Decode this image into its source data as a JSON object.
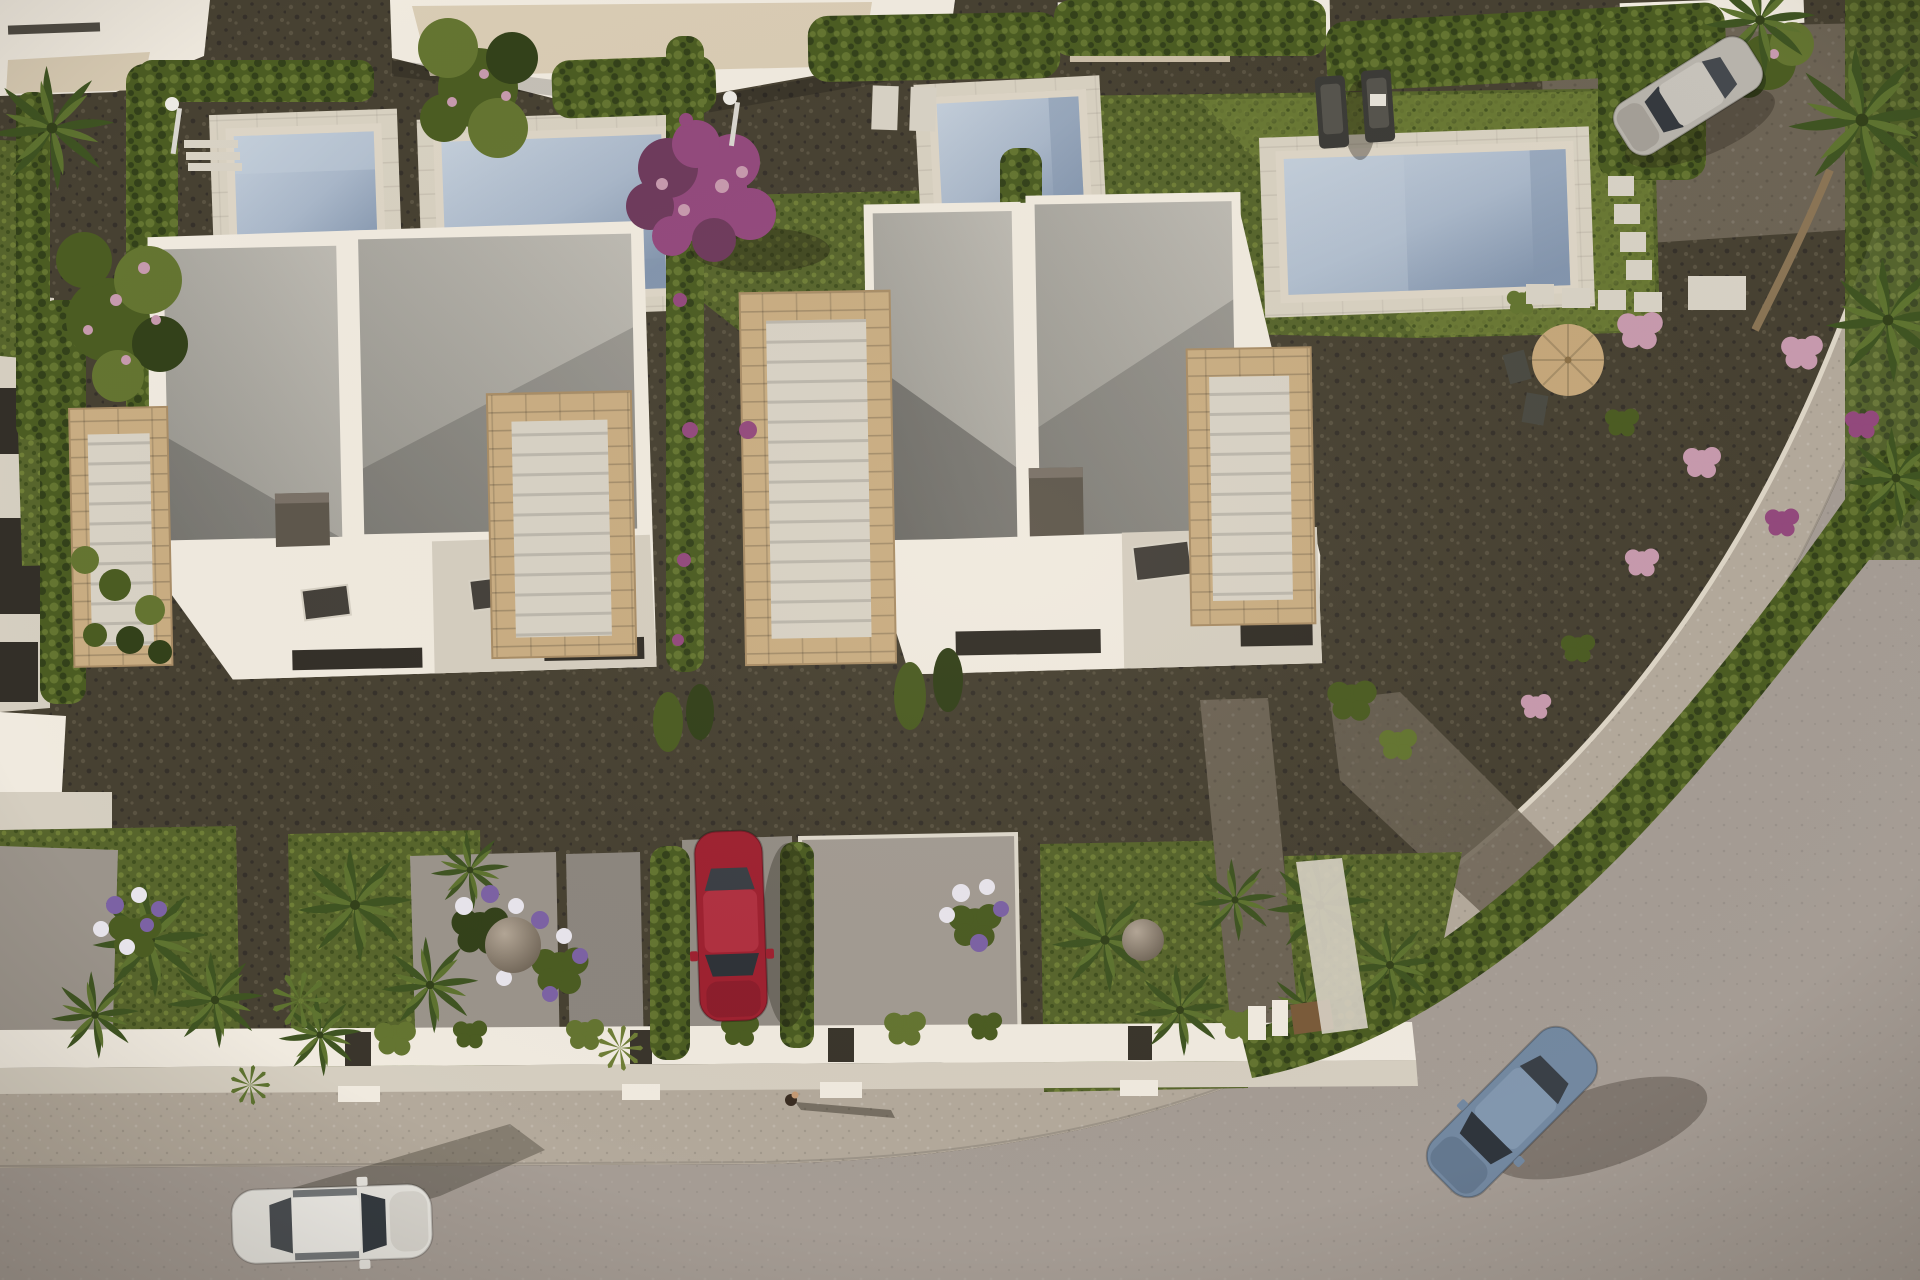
{
  "meta": {
    "title": "Aerial 3D architectural rendering of modern white villas with private pools",
    "view": "top-down bird's-eye view, late-afternoon warm sunlight, long shadows cast to the east",
    "width_px": 1920,
    "height_px": 1280
  },
  "palette": {
    "gravel": "#474132",
    "gravel_light": "#5a5342",
    "gravel_dark": "#36312a",
    "drive_gravel": "#6d6455",
    "tan_path": "#8f7f66",
    "grass": "#57652c",
    "grass_light": "#6f7e37",
    "grass_dark": "#41501f",
    "hedge": "#4b5c22",
    "hedge_light": "#647531",
    "hedge_dark": "#33411a",
    "road": "#a59c94",
    "sidewalk": "#b3a99b",
    "curb": "#ddd5c6",
    "wall": "#f0eadf",
    "wall_shade": "#d5cec0",
    "deck": "#d8d1c1",
    "terrace": "#d9ccb4",
    "roof_light": "#bebbb3",
    "roof_mid": "#94928b",
    "roof_deep": "#63655f",
    "stone": "#c9ad82",
    "stone_dark": "#a98d66",
    "steps": "#d8d2c5",
    "chimney": "#5e574c",
    "chimney_top": "#7a7167",
    "window_dark": "#332f28",
    "water": "#a9b7c9",
    "water_light": "#c3ceda",
    "water_dark": "#8395ad",
    "car_white": "#e8e6e0",
    "car_white_roof": "#f1efeа",
    "car_red": "#9e2130",
    "car_red_roof": "#b03040",
    "car_blue": "#7388a0",
    "car_blue_roof": "#8297ae",
    "car_silver": "#b7b3ab",
    "glass": "#343a40",
    "flower_magenta": "#93497d",
    "flower_magenta_dark": "#6e3a5c",
    "flower_purple": "#7c62a4",
    "flower_pink": "#c79aae",
    "flower_white": "#e8e5ec",
    "palm": "#5e7330",
    "palm_dark": "#3f5422",
    "trunk": "#8a7455",
    "parasol": "#c5a77a",
    "lounger": "#3c3b37",
    "lounger_pad": "#56544d",
    "sphere_light": "#b3a696",
    "sphere_dark": "#6e6355",
    "gate_wood": "#7a5b3a",
    "skin": "#c49a74",
    "shadow": "rgba(28,22,13,0.35)"
  },
  "scene": {
    "buildings": [
      {
        "id": "villa-left",
        "description": "two-storey white villa, flat grey double roof panels with white parapets, dark roof hatch, travertine stair volumes on both sides, skylights, shaded ground-floor terrace"
      },
      {
        "id": "villa-right",
        "description": "matching white villa with grey double roof, travertine staircase volumes, dark roof hatch and skylight, ground-floor terrace with dark glazing"
      },
      {
        "id": "neighbor-top-left",
        "description": "partially visible white neighbour house at the top-left corner with beige roof terrace"
      },
      {
        "id": "neighbor-top-center",
        "description": "partially visible white neighbour house along the top edge with beige terrace"
      },
      {
        "id": "neighbor-top-right-strips",
        "description": "white building slivers cut by the top edge"
      },
      {
        "id": "neighbor-left-edge",
        "description": "white building facade with dark vertical windows cut by the left edge"
      }
    ],
    "pools": [
      {
        "id": "pool-1",
        "location": "upper left plot",
        "water": "pale blue",
        "deck": "light beige"
      },
      {
        "id": "pool-2",
        "location": "upper centre-left plot, behind cypress hedge"
      },
      {
        "id": "pool-3",
        "location": "upper centre plot, angled"
      },
      {
        "id": "pool-4",
        "location": "upper right plot, largest, with sun deck"
      }
    ],
    "vehicles": [
      {
        "id": "car-white",
        "color": "white",
        "location": "driving on the road, bottom left, heading right"
      },
      {
        "id": "car-red",
        "color": "dark red",
        "location": "parked nose-down in the centre driveway"
      },
      {
        "id": "car-blue",
        "color": "steel blue",
        "location": "driving down the curved road, bottom right"
      },
      {
        "id": "car-silver",
        "color": "silver grey",
        "location": "parked on the gravel drive, top right"
      }
    ],
    "people": [
      {
        "id": "pedestrian",
        "description": "single person on the sidewalk at centre casting a long shadow to the right"
      }
    ],
    "landscaping": [
      "dark gravel plots between houses",
      "clipped cypress hedges dividing gardens",
      "magenta bougainvillea tree between the villas",
      "pink-blossom trees top-left and top-right",
      "fan palms in the street-front gardens and along the right edge",
      "lavender-purple and white flower beds",
      "round pebble decor spheres",
      "stepping-stone paths in the right garden",
      "two dark sun loungers on the right lawn",
      "tan parasol with bistro chairs",
      "two outdoor pool showers",
      "agave/yucca tufts by the front walls"
    ],
    "hardscape": [
      "white front boundary walls with entrance steps",
      "grey private driveways meeting the sidewalk",
      "light speckled sidewalk strip",
      "warm grey asphalt road curving from bottom-left around the right side"
    ]
  }
}
